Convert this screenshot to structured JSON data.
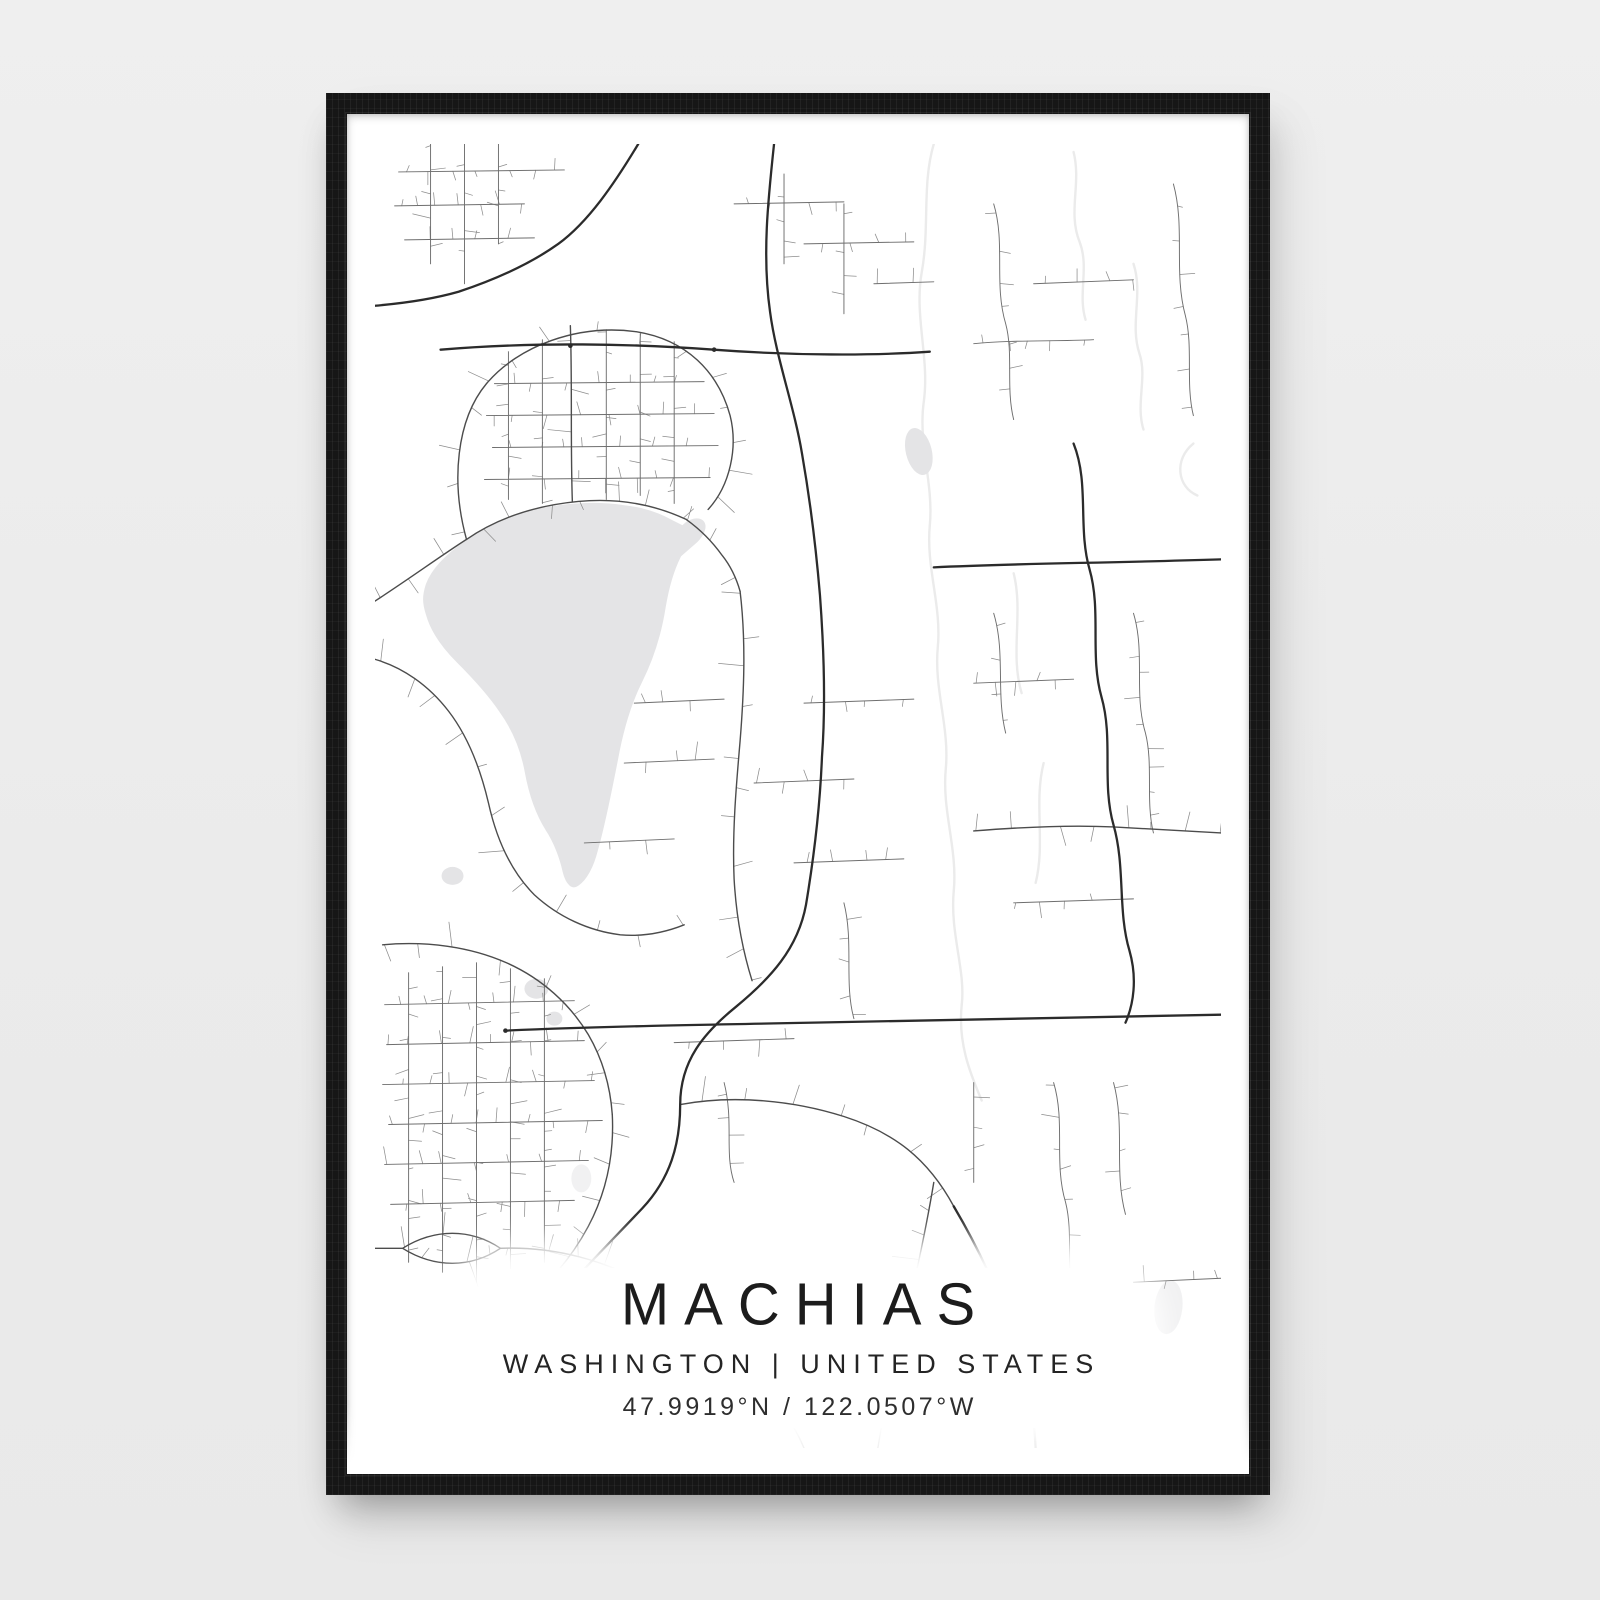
{
  "poster": {
    "title": "MACHIAS",
    "subtitle": "WASHINGTON | UNITED STATES",
    "coordinates": "47.9919°N / 122.0507°W"
  },
  "colors": {
    "background": "#ececec",
    "frame": "#161616",
    "paper": "#ffffff",
    "water": "#e4e4e6",
    "pond_faint": "#f1f1f2",
    "stream": "#ebebeb",
    "road_major": "#2b2b2b",
    "road_medium": "#4c4c4c",
    "road_minor": "#6e6e6e",
    "twig": "#8d8d8d"
  },
  "map": {
    "viewbox": "0 0 848 1306",
    "twig_seed": 1337,
    "lake": "M50,440 C56,424 70,410 90,396 C112,380 136,370 162,364 C190,358 222,356 248,360 C268,362 286,368 300,376 L308,380 C314,374 324,371 330,376 C336,382 332,392 324,400 L308,414 C301,428 296,446 293,464 C289,490 281,516 269,540 C257,564 250,590 245,618 C239,648 233,680 225,708 C221,724 214,738 205,744 C197,750 190,742 187,730 C184,716 178,700 170,688 C160,672 153,652 149,630 C145,608 137,588 124,570 C112,552 97,536 81,520 C67,506 55,490 50,472 C46,460 46,452 50,440 Z",
    "ponds": [
      {
        "cx": 545,
        "cy": 308,
        "rx": 13,
        "ry": 24,
        "rot": -14,
        "faint": false
      },
      {
        "cx": 162,
        "cy": 846,
        "rx": 12,
        "ry": 10,
        "rot": 0,
        "faint": false
      },
      {
        "cx": 180,
        "cy": 876,
        "rx": 8,
        "ry": 7,
        "rot": 0,
        "faint": false
      },
      {
        "cx": 78,
        "cy": 733,
        "rx": 11,
        "ry": 9,
        "rot": 0,
        "faint": false
      },
      {
        "cx": 795,
        "cy": 1165,
        "rx": 14,
        "ry": 27,
        "rot": 6,
        "faint": true
      },
      {
        "cx": 207,
        "cy": 1036,
        "rx": 10,
        "ry": 14,
        "rot": 0,
        "faint": true
      }
    ],
    "streams": [
      "M560,0 C548,40 556,84 548,128 C540,172 556,214 550,258 C544,300 560,340 556,382 C552,424 568,462 564,504 C560,546 576,584 572,626 C568,668 584,706 580,748 C576,790 592,828 588,862",
      "M588,862 C584,900 596,930 608,958",
      "M700,8 C708,40 694,68 706,98 C716,124 704,150 712,176",
      "M760,120 C770,150 756,180 766,210 C774,234 762,260 770,286",
      "M820,300 C800,316 804,344 824,352",
      "M640,430 C650,470 636,510 648,550",
      "M670,620 C660,660 672,700 662,740"
    ],
    "roads_major": [
      "M264,0 C240,40 214,78 184,100 C156,120 120,136 84,148 C56,156 24,160 0,162",
      "M66,206 C160,198 260,200 340,206 C420,212 500,212 556,208",
      "M400,0 C394,56 388,112 396,168 C402,214 420,262 428,310 C436,356 442,404 446,452 C450,506 452,560 448,614 C446,664 440,714 432,762 C424,806 396,836 362,864 C330,890 306,918 306,962 C306,1002 296,1036 268,1066 C234,1102 186,1150 152,1192 C136,1212 126,1228 118,1248",
      "M131,888 C220,884 330,882 440,880 C560,878 700,876 848,872",
      "M560,424 C640,420 720,420 848,416",
      "M700,300 C716,340 704,384 716,426 C728,468 716,512 728,554 C740,596 728,640 740,682 C752,724 744,768 756,808 C764,836 760,862 752,880",
      "M580,1064 C606,1108 628,1156 644,1204 C654,1234 660,1266 662,1306"
    ],
    "roads_medium": [
      "M0,458 C34,436 64,414 92,396 C124,374 162,362 204,358 C246,354 282,362 312,376",
      "M312,376 C326,386 338,398 348,412 C356,422 362,434 366,448",
      "M0,516 C28,524 54,542 74,568 C94,594 106,626 114,660 C122,696 136,728 160,752 C184,774 214,788 246,792 C268,794 290,790 310,782",
      "M92,396 C76,338 82,276 112,240 C144,202 204,180 262,188 C312,196 344,228 356,272 C364,304 356,342 334,366",
      "M196,182 C198,240 196,300 198,358",
      "M8,802 C52,798 96,804 132,820 C168,836 196,862 214,892 C228,916 236,944 238,972",
      "M238,972 C240,1012 232,1050 214,1084 C198,1114 176,1140 150,1160",
      "M600,688 C650,684 700,682 740,684 C780,686 816,688 848,690",
      "M366,448 C372,498 370,548 366,598 C362,644 358,690 360,736 C362,772 368,806 378,838",
      "M0,1106 L28,1106 C60,1086 96,1086 126,1106 C96,1126 60,1126 28,1106",
      "M126,1106 C180,1104 232,1118 276,1144 C318,1168 354,1200 384,1236 C404,1260 420,1282 430,1306",
      "M560,1040 C550,1100 536,1160 522,1220 C514,1252 508,1280 504,1306",
      "M306,962 C360,952 420,958 470,974 C520,990 554,1016 580,1064"
    ],
    "roads_minor": [
      "M120,240 L330,238",
      "M112,272 L340,270",
      "M118,304 L344,302",
      "M110,336 L336,334",
      "M134,208 L134,356",
      "M168,196 L168,360",
      "M232,186 L232,356",
      "M266,190 L266,352",
      "M300,198 L300,360",
      "M24,28 L190,26",
      "M56,0 L56,120",
      "M90,0 L90,140",
      "M124,0 L124,100",
      "M20,62 L150,60",
      "M30,96 L160,94",
      "M410,30 L410,120",
      "M360,60 L470,58",
      "M470,60 L470,170",
      "M430,100 L540,98",
      "M500,140 L560,138",
      "M34,830 L34,1120",
      "M68,824 L68,1130",
      "M102,820 L102,1140",
      "M136,826 L136,1150",
      "M170,836 L170,1120",
      "M10,862 L200,858",
      "M12,902 L210,898",
      "M8,942 L220,938",
      "M14,982 L228,978",
      "M10,1022 L214,1018",
      "M16,1062 L200,1058",
      "M620,60 C632,100 620,140 632,180 C640,210 632,244 640,276",
      "M800,40 C812,84 800,128 812,172 C820,204 812,240 820,272",
      "M660,140 L760,136",
      "M600,200 C640,196 680,198 720,196",
      "M760,470 C772,510 760,550 772,590 C780,622 772,658 780,690",
      "M620,470 C632,510 622,550 632,590",
      "M600,540 L700,536",
      "M640,760 L760,756",
      "M680,940 C692,980 680,1020 692,1060 C700,1092 692,1128 700,1160",
      "M740,940 C752,984 740,1028 752,1072",
      "M600,940 L600,1040",
      "M760,1140 L848,1136",
      "M620,1200 C660,1196 700,1198 740,1196",
      "M430,560 L540,556",
      "M380,640 L480,636",
      "M420,720 L530,716",
      "M470,760 C480,800 470,840 480,876",
      "M250,620 L340,616",
      "M260,560 L350,556",
      "M300,900 L420,896",
      "M350,940 C360,980 350,1010 360,1040",
      "M210,700 L300,696"
    ],
    "node_dots": [
      {
        "x": 340,
        "y": 206
      },
      {
        "x": 196,
        "y": 202
      },
      {
        "x": 131,
        "y": 888
      }
    ]
  }
}
